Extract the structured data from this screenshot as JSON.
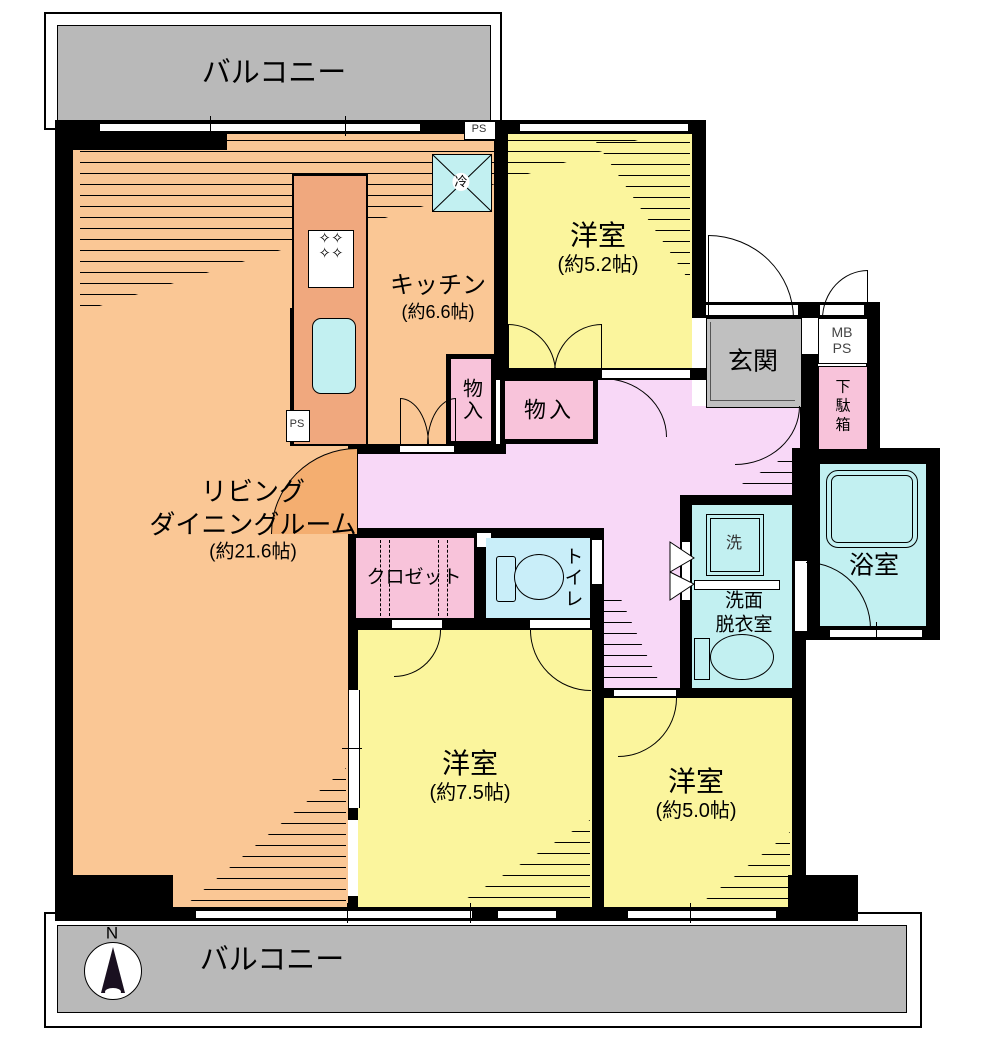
{
  "colors": {
    "wall": "#000000",
    "balcony_gray": "#b9b9b9",
    "genkan_gray": "#c0c0c0",
    "ldk_orange": "#fac795",
    "ldk_sector": "#f4ae70",
    "counter_salmon": "#f0a87e",
    "room_yellow": "#fbf59d",
    "hall_pink": "#f8d8f7",
    "storage_pink": "#f8c3da",
    "water_cyan": "#c2f0f1",
    "toilet_cyan": "#c9eef9"
  },
  "labels": {
    "balcony_top": "バルコニー",
    "balcony_bottom": "バルコニー",
    "compass_north": "N",
    "ldk_line1": "リビング",
    "ldk_line2": "ダイニングルーム",
    "ldk_size": "(約21.6帖)",
    "kitchen": "キッチン",
    "kitchen_size": "(約6.6帖)",
    "bedroom_tr": "洋室",
    "bedroom_tr_size": "(約5.2帖)",
    "bedroom_bm": "洋室",
    "bedroom_bm_size": "(約7.5帖)",
    "bedroom_br": "洋室",
    "bedroom_br_size": "(約5.0帖)",
    "entrance": "玄関",
    "mb": "MB",
    "ps_meter": "PS",
    "ps_top": "PS",
    "ps_kitchen": "PS",
    "shoe_cabinet": "下駄箱",
    "bathroom": "浴室",
    "washroom_line1": "洗面",
    "washroom_line2": "脱衣室",
    "washer": "洗",
    "toilet": "トイレ",
    "closet": "クロゼット",
    "storage_small": "物入",
    "storage_large": "物入",
    "refrigerator": "冷"
  }
}
